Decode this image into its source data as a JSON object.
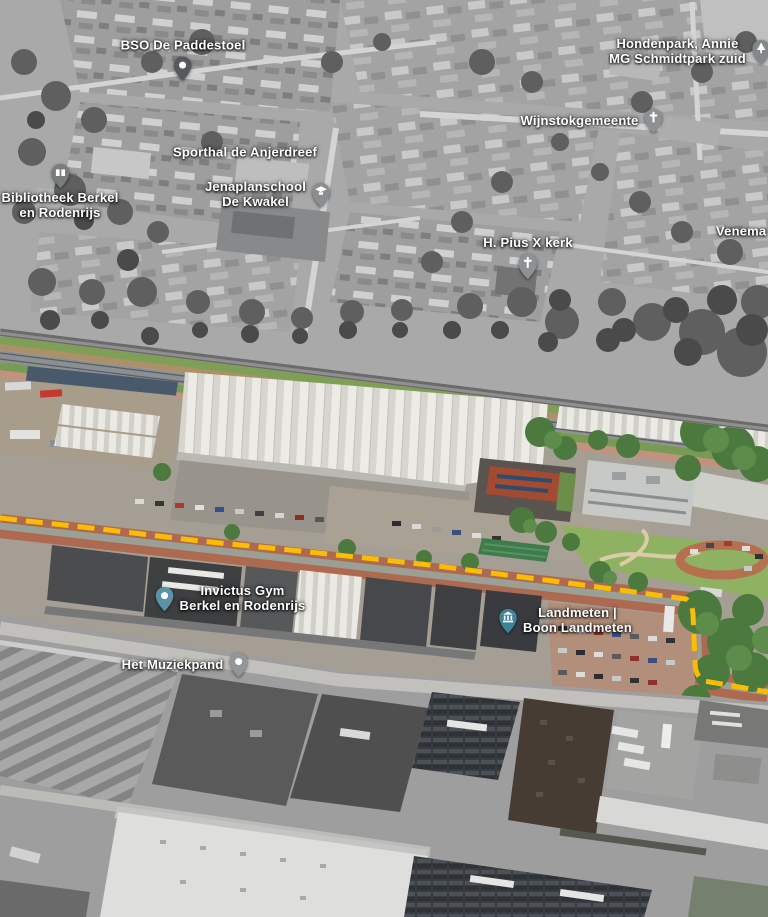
{
  "map": {
    "view_type": "3D aerial satellite view with highlighted area",
    "boundary": {
      "style": "dashed",
      "color": "#FBBC05"
    },
    "colors": {
      "boundary_yellow": "#FBBC05",
      "poi_pin_teal": "#4E8FA0",
      "poi_pin_gray": "#6B6F73",
      "brick_road": "#AE6A50",
      "lawn_green": "#8FB162"
    },
    "labels": {
      "bso": {
        "text": "BSO De Paddestoel",
        "pin": "place-pin"
      },
      "hondenpark": {
        "line1": "Hondenpark, Annie",
        "line2": "MG Schmidtpark zuid",
        "pin": "park-tree-pin"
      },
      "wijnstok": {
        "text": "Wijnstokgemeente",
        "pin": "church-pin"
      },
      "sporthal": {
        "text": "Sporthal de Anjerdreef"
      },
      "bibliotheek": {
        "line1": "Bibliotheek Berkel",
        "line2": "en Rodenrijs",
        "pin": "library-book-pin"
      },
      "jenaplan": {
        "line1": "Jenaplanschool",
        "line2": "De Kwakel",
        "pin": "school-cap-pin"
      },
      "pius": {
        "text": "H. Pius X kerk",
        "pin": "church-pin"
      },
      "venema": {
        "text": "Venema &"
      },
      "invictus": {
        "line1": "Invictus Gym",
        "line2": "Berkel en Rodenrijs",
        "pin": "poi-dot-pin"
      },
      "landmeten": {
        "line1": "Landmeten |",
        "line2": "Boon Landmeten",
        "pin": "landmark-bank-pin"
      },
      "muziekpand": {
        "text": "Het Muziekpand",
        "pin": "poi-dot-pin"
      }
    }
  }
}
